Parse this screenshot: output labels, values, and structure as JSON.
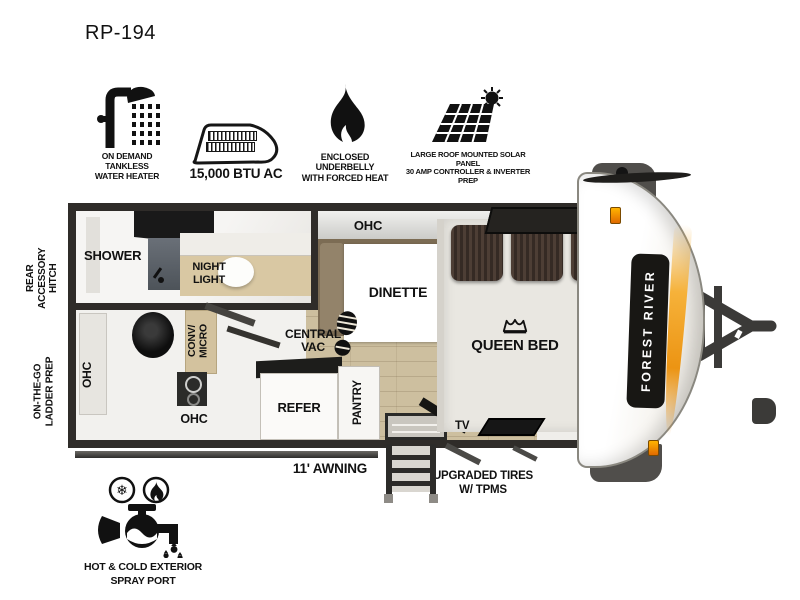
{
  "title": "RP-194",
  "features": [
    {
      "icon": "shower-head-icon",
      "label": "ON DEMAND\nTANKLESS\nWATER HEATER"
    },
    {
      "icon": "ac-unit-icon",
      "label": "15,000 BTU AC"
    },
    {
      "icon": "flame-icon",
      "label": "ENCLOSED UNDERBELLY\nWITH FORCED HEAT"
    },
    {
      "icon": "solar-panel-icon",
      "label": "LARGE ROOF MOUNTED SOLAR PANEL\n30 AMP CONTROLLER & INVERTER PREP"
    }
  ],
  "floorplan": {
    "shower": "SHOWER",
    "night_light": "NIGHT\nLIGHT",
    "ohc_top": "OHC",
    "dinette": "DINETTE",
    "queen_bed": "QUEEN BED",
    "central_vac": "CENTRAL\nVAC",
    "ohc_left": "OHC",
    "conv_micro": "CONV/\nMICRO",
    "ohc_bottom": "OHC",
    "refer": "REFER",
    "pantry": "PANTRY",
    "tv": "TV",
    "brand": "FOREST RIVER"
  },
  "exterior": {
    "rear_hitch": "REAR\nACCESSORY\nHITCH",
    "ladder_prep": "ON-THE-GO\nLADDER PREP",
    "awning": "11' AWNING",
    "tires": "UPGRADED TIRES\nW/ TPMS",
    "spray_port": "HOT & COLD EXTERIOR\nSPRAY PORT"
  },
  "colors": {
    "accent_orange": "#ef9716",
    "wall": "#2f2c29",
    "floor_tan": "#cdbf9f",
    "bench_brown": "#7c6c54",
    "pillow_brown": "#453931"
  }
}
